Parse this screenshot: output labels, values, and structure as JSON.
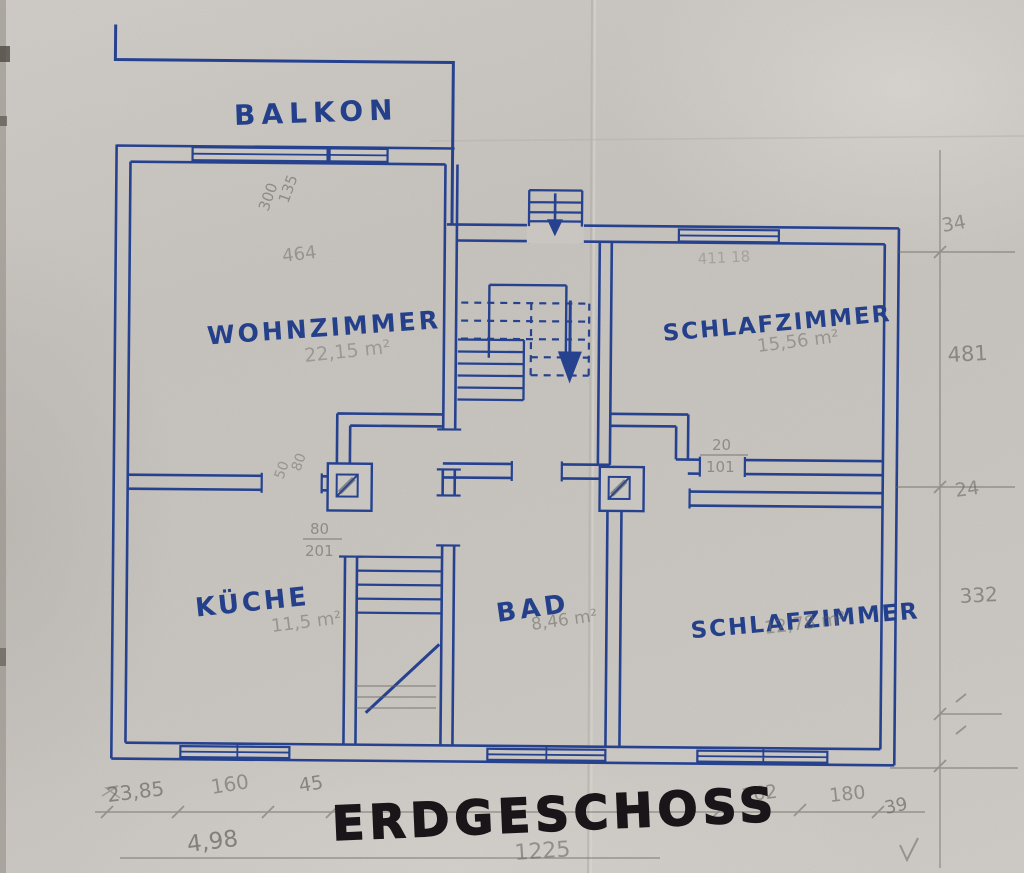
{
  "title": "ERDGESCHOSS",
  "colors": {
    "ink": "#26428f",
    "pencil": "#6b6761",
    "marker": "#191519",
    "paper": "#c9c5c0"
  },
  "rooms": [
    {
      "id": "balkon",
      "label": "BALKON",
      "area_note": ""
    },
    {
      "id": "wohnzimmer",
      "label": "WOHNZIMMER",
      "area_note": "22,15 m²"
    },
    {
      "id": "schlafzimmer-top",
      "label": "SCHLAFZIMMER",
      "area_note": "15,56 m²"
    },
    {
      "id": "kueche",
      "label": "KÜCHE",
      "area_note": "11,5 m²"
    },
    {
      "id": "bad",
      "label": "BAD",
      "area_note": "8,46 m²"
    },
    {
      "id": "schlafzimmer-bottom",
      "label": "SCHLAFZIMMER",
      "area_note": "12,78 m²"
    }
  ],
  "pencil_notes": {
    "balcony_door_w": "300",
    "balcony_door_h": "135",
    "wohnzimmer_width": "464",
    "schlafzimmer_top_faint": "411 18",
    "right_1": "34",
    "right_2": "481",
    "right_3": "24",
    "right_4": "332",
    "chimney_rot_1": "50",
    "chimney_rot_2": "80",
    "frac1_top": "80",
    "frac1_bot": "201",
    "frac2_top": "20",
    "frac2_bot": "101",
    "bottom_1": "23,85",
    "bottom_2": "160",
    "bottom_3": "45",
    "bottom_4": "162",
    "bottom_5": "180",
    "bottom_6": "39",
    "bottom_total_left": "4,98",
    "bottom_total": "1225"
  }
}
